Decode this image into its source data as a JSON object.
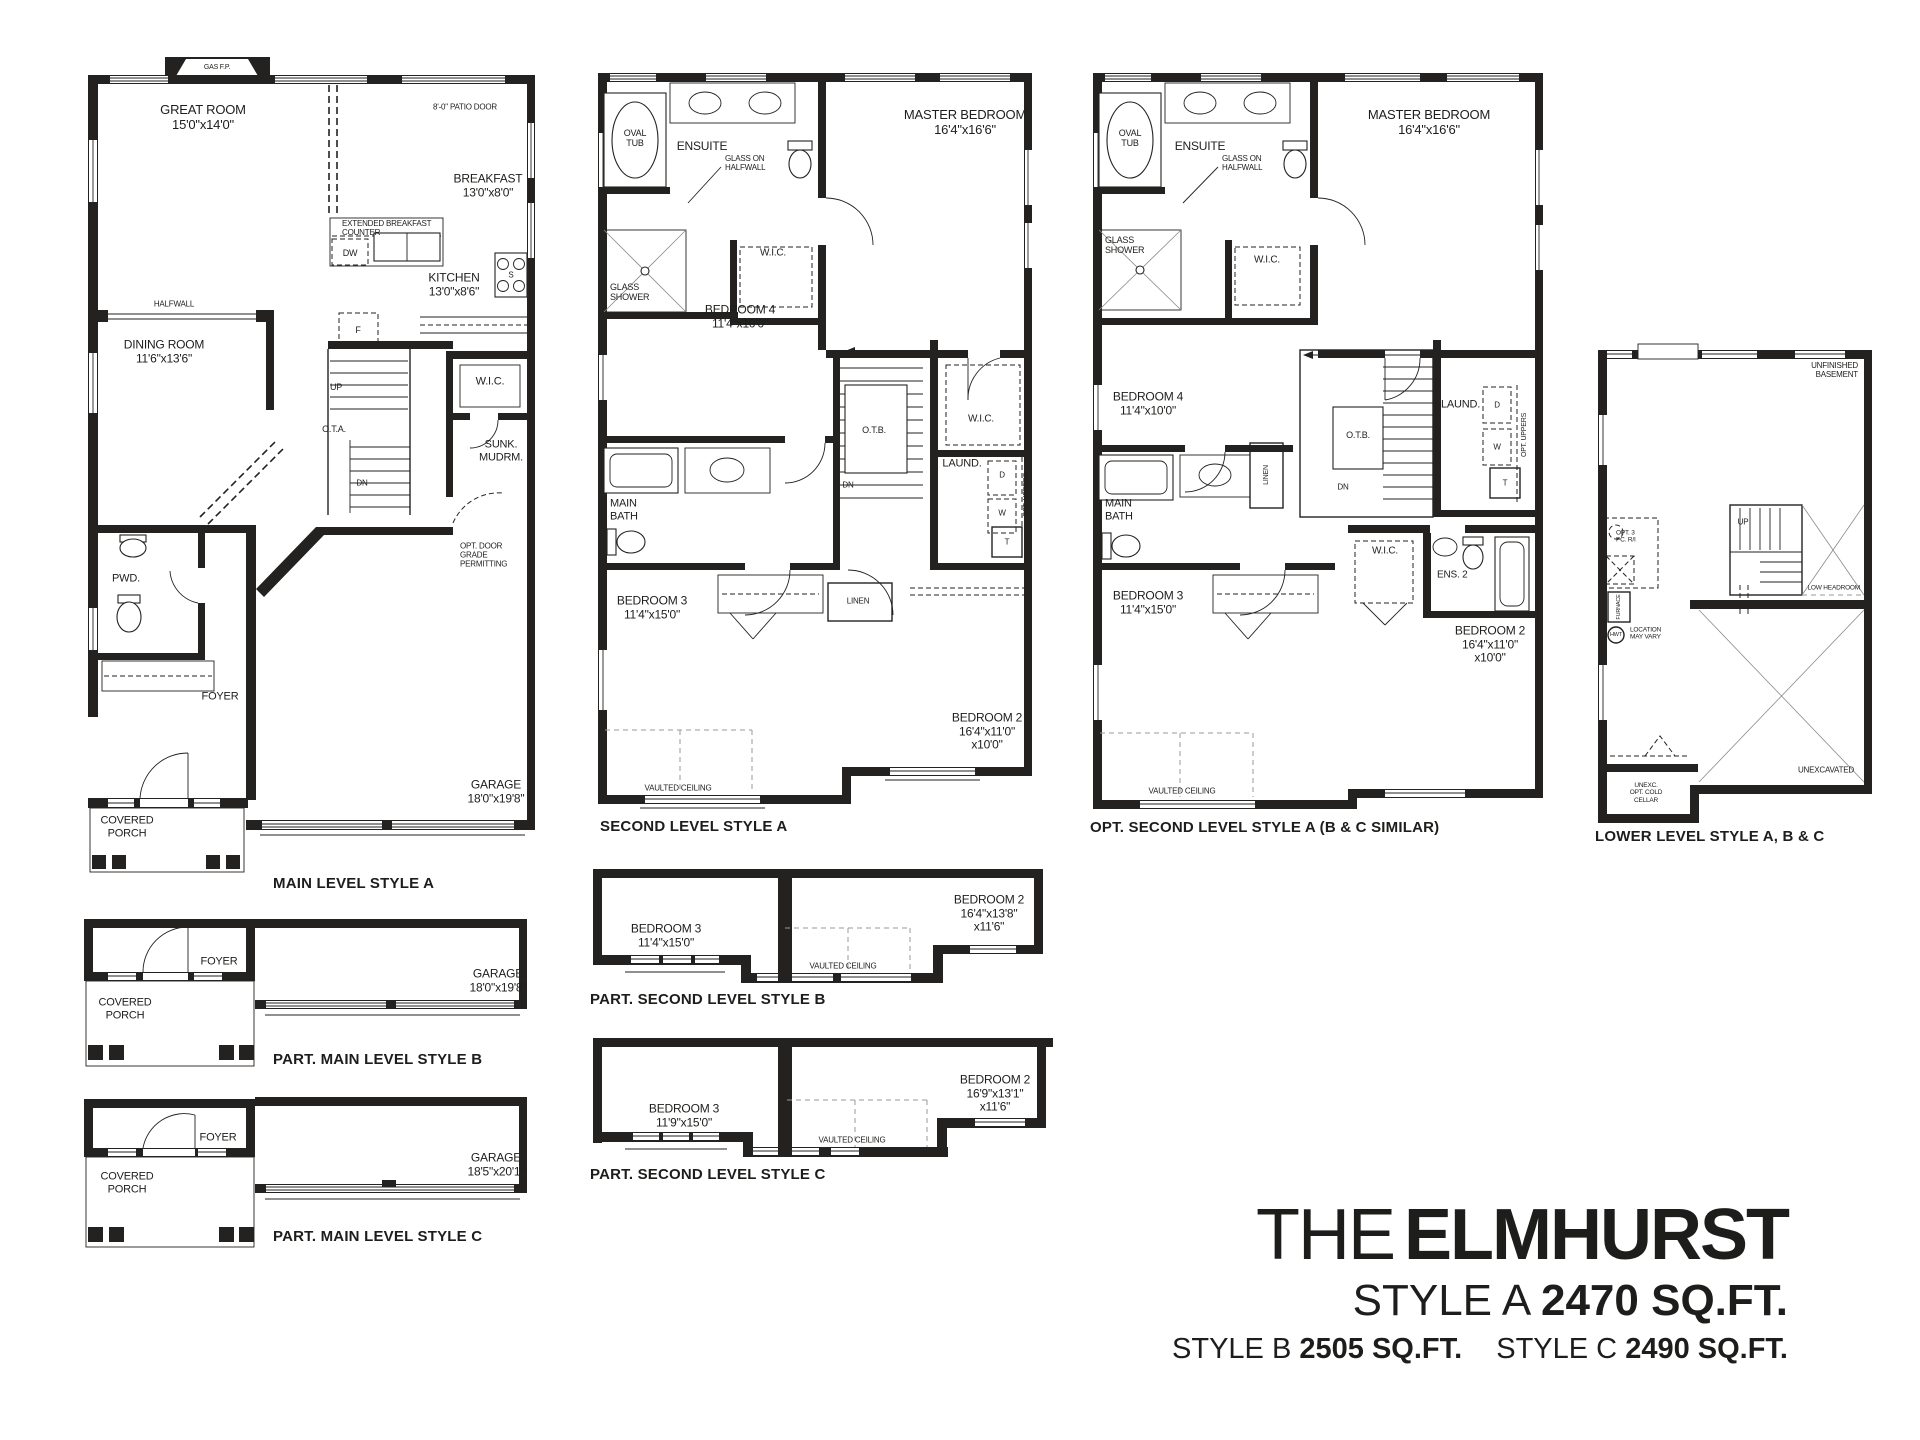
{
  "title_block": {
    "prefix": "THE",
    "name": "ELMHURST",
    "style_a": "STYLE A",
    "sqft_a": "2470 SQ.FT.",
    "style_b": "STYLE B",
    "sqft_b": "2505 SQ.FT.",
    "style_c": "STYLE C",
    "sqft_c": "2490 SQ.FT."
  },
  "colors": {
    "ink": "#1d1d1b",
    "paper": "#ffffff"
  },
  "plans": {
    "main_a": {
      "caption": "MAIN LEVEL STYLE A",
      "gas_fp": "GAS F.P.",
      "great_room": "GREAT ROOM\n15'0\"x14'0\"",
      "patio_door": "8'-0\" PATIO DOOR",
      "breakfast": "BREAKFAST\n13'0\"x8'0\"",
      "ext_counter": "EXTENDED BREAKFAST\nCOUNTER",
      "dw": "DW",
      "stove": "S",
      "kitchen": "KITCHEN\n13'0\"x8'6\"",
      "halfwall": "HALFWALL",
      "dining": "DINING ROOM\n11'6\"x13'6\"",
      "fridge": "F",
      "up": "UP",
      "ota": "O.T.A.",
      "dn": "DN",
      "wic": "W.I.C.",
      "mudroom": "SUNK.\nMUDRM.",
      "opt_door": "OPT. DOOR\nGRADE\nPERMITTING",
      "pwd": "PWD.",
      "foyer": "FOYER",
      "porch": "COVERED\nPORCH",
      "garage": "GARAGE\n18'0\"x19'8\""
    },
    "second_a": {
      "caption": "SECOND LEVEL STYLE A",
      "oval_tub": "OVAL\nTUB",
      "ensuite": "ENSUITE",
      "glass_halfwall": "GLASS ON\nHALFWALL",
      "glass_shower": "GLASS\nSHOWER",
      "wic_ensuite": "W.I.C.",
      "master": "MASTER BEDROOM\n16'4\"x16'6\"",
      "bedroom4": "BEDROOM 4\n11'4\"x10'0\"",
      "otb": "O.T.B.",
      "dn": "DN",
      "wic_master": "W.I.C.",
      "laundry": "LAUND.",
      "dryer": "D",
      "washer": "W",
      "opt_uppers": "OPT. UPPERS",
      "tub_t": "T",
      "main_bath": "MAIN\nBATH",
      "linen": "LINEN",
      "bedroom3": "BEDROOM 3\n11'4\"x15'0\"",
      "bedroom2": "BEDROOM 2\n16'4\"x11'0\"\nx10'0\"",
      "vaulted": "VAULTED CEILING"
    },
    "opt_second_a": {
      "caption": "OPT. SECOND LEVEL STYLE A (B & C SIMILAR)",
      "oval_tub": "OVAL\nTUB",
      "ensuite": "ENSUITE",
      "glass_halfwall": "GLASS ON\nHALFWALL",
      "glass_shower": "GLASS\nSHOWER",
      "wic_ensuite": "W.I.C.",
      "master": "MASTER BEDROOM\n16'4\"x16'6\"",
      "bedroom4": "BEDROOM 4\n11'4\"x10'0\"",
      "otb": "O.T.B.",
      "dn": "DN",
      "laundry": "LAUND.",
      "dryer": "D",
      "washer": "W",
      "opt_uppers": "OPT. UPPERS",
      "tub_t": "T",
      "main_bath": "MAIN\nBATH",
      "linen": "LINEN",
      "wic_b2": "W.I.C.",
      "ens2": "ENS. 2",
      "bedroom3": "BEDROOM 3\n11'4\"x15'0\"",
      "bedroom2": "BEDROOM 2\n16'4\"x11'0\"\nx10'0\"",
      "vaulted": "VAULTED CEILING"
    },
    "lower": {
      "caption": "LOWER LEVEL STYLE A, B & C",
      "unfinished": "UNFINISHED\nBASEMENT",
      "up": "UP",
      "low_headroom": "LOW HEADROOM",
      "opt_3pc": "OPT. 3\nPC. R/I",
      "furnace": "FURNACE",
      "hwt": "HWT",
      "location": "LOCATION\nMAY VARY",
      "unexcavated": "UNEXCAVATED",
      "cold_cellar": "UNEXC.\nOPT. COLD\nCELLAR"
    },
    "part_main_b": {
      "caption": "PART. MAIN LEVEL STYLE B",
      "foyer": "FOYER",
      "porch": "COVERED\nPORCH",
      "garage": "GARAGE\n18'0\"x19'8\""
    },
    "part_main_c": {
      "caption": "PART. MAIN LEVEL STYLE C",
      "foyer": "FOYER",
      "porch": "COVERED\nPORCH",
      "garage": "GARAGE\n18'5\"x20'1\""
    },
    "part_second_b": {
      "caption": "PART. SECOND LEVEL STYLE B",
      "bedroom3": "BEDROOM 3\n11'4\"x15'0\"",
      "vaulted": "VAULTED CEILING",
      "bedroom2": "BEDROOM 2\n16'4\"x13'8\"\nx11'6\""
    },
    "part_second_c": {
      "caption": "PART. SECOND LEVEL STYLE C",
      "bedroom3": "BEDROOM 3\n11'9\"x15'0\"",
      "vaulted": "VAULTED CEILING",
      "bedroom2": "BEDROOM 2\n16'9\"x13'1\"\nx11'6\""
    }
  }
}
